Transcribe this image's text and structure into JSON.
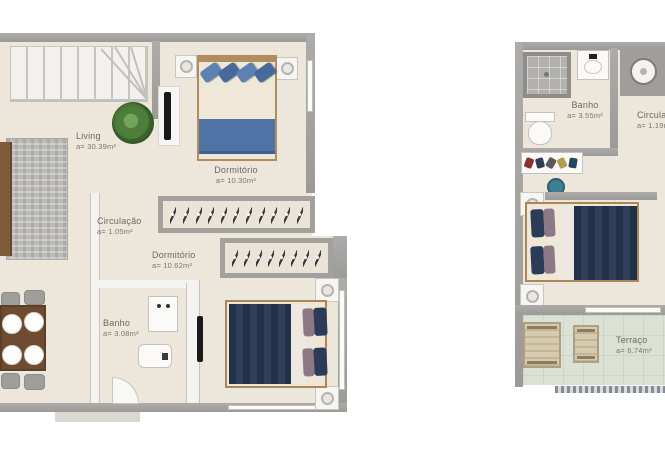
{
  "colors": {
    "wall_gray": "#a5a3a0",
    "floor_cream": "#ece6db",
    "bed_navy": "#28384f",
    "pillow_blue": "#5d81b0",
    "pillow_mauve": "#8d7886",
    "wood_frame": "#b08d5e",
    "plant_green": "#4e7d3c",
    "terrace_floor": "#dce1d6",
    "label_text": "#6e695f"
  },
  "left_plan": {
    "rooms": {
      "living": {
        "label": "Living",
        "area": "a= 30.39m²"
      },
      "dormitorio1": {
        "label": "Dormitório",
        "area": "a= 10.30m²"
      },
      "circulacao": {
        "label": "Circulação",
        "area": "a= 1.05m²"
      },
      "dormitorio2": {
        "label": "Dormitório",
        "area": "a= 10.62m²"
      },
      "banho": {
        "label": "Banho",
        "area": "a= 3.08m²"
      }
    },
    "closets": {
      "closet1_hangers": 11,
      "closet2_hangers": 8
    }
  },
  "right_plan": {
    "rooms": {
      "banho": {
        "label": "Banho",
        "area": "a= 3.55m²"
      },
      "circulacao": {
        "label": "Circulação",
        "area": "a= 1.19m²"
      },
      "terraco": {
        "label": "Terraço",
        "area": "a= 6.74m²"
      }
    }
  }
}
